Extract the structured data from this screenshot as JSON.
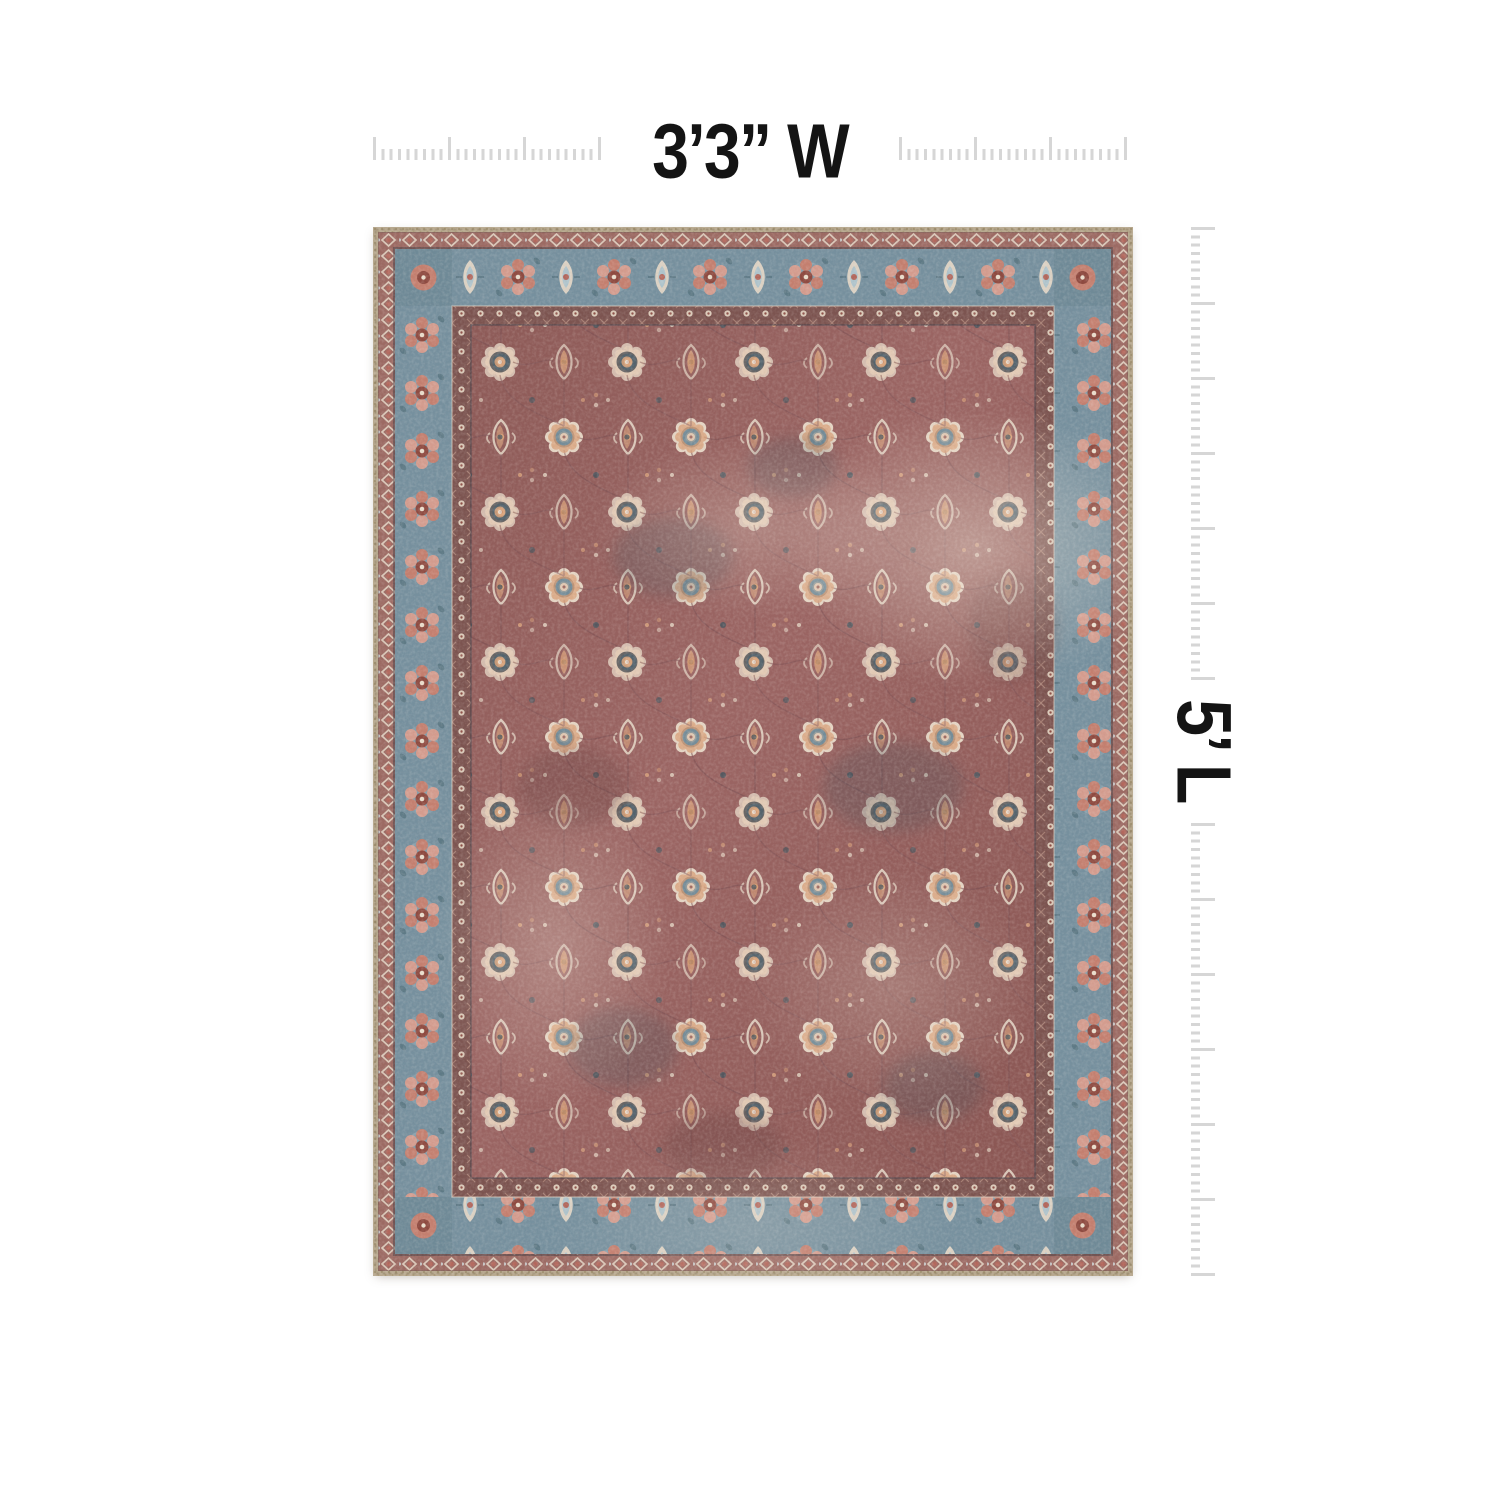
{
  "page": {
    "type": "product-dimension-image",
    "description": "Vintage persian-style area rug shown flat with width and length rulers"
  },
  "labels": {
    "width": "3’3” W",
    "length": "5’ L"
  },
  "rulers": {
    "width_major_tick_count": 4,
    "length_major_tick_count_per_segment": 7,
    "minor_ticks_between_majors": 8
  },
  "colors": {
    "page_background": "#ffffff",
    "label": "#141414",
    "tick": "#d6d6d6",
    "rug_palette": {
      "binding_tan": "#b7a88e",
      "border_slate_blue": "#76909e",
      "guard_rose": "#9c6a63",
      "guard_dark_mauve": "#7c5450",
      "field_mauve": "#9b6563",
      "accent_cream": "#e4d4c3",
      "accent_peach": "#d9a27c",
      "accent_rust": "#b2675c",
      "accent_dark_slate": "#49555e"
    }
  }
}
